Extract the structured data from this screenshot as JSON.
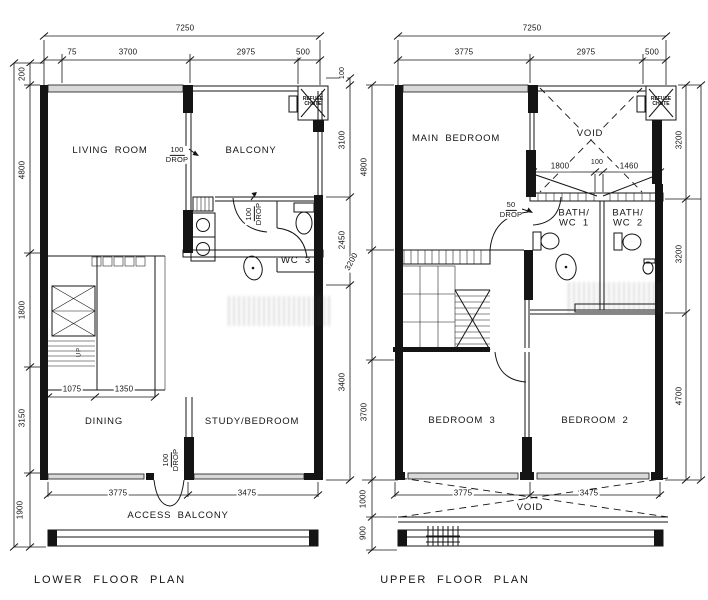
{
  "lower": {
    "title": "LOWER FLOOR PLAN",
    "room_living": "LIVING ROOM",
    "room_balcony": "BALCONY",
    "room_wc3": "WC 3",
    "room_dining": "DINING",
    "room_study": "STUDY/BEDROOM",
    "access_balcony": "ACCESS BALCONY",
    "refuse_chute_l1": "REFUSE",
    "refuse_chute_l2": "CHUTE",
    "up_label": "UP",
    "drop_note_l1": "100",
    "drop_note_l2": "DROP",
    "dim_total_top": "7250",
    "dim_top_75": "75",
    "dim_top_3700": "3700",
    "dim_top_2975": "2975",
    "dim_top_500": "500",
    "dim_left_200": "200",
    "dim_left_4800": "4800",
    "dim_left_1800": "1800",
    "dim_left_3150": "3150",
    "dim_left_1900": "1900",
    "dim_right_100": "100",
    "dim_right_3100": "3100",
    "dim_right_2450": "2450",
    "dim_right_3400": "3400",
    "dim_stair_1075": "1075",
    "dim_stair_1350": "1350",
    "dim_bottom_3775": "3775",
    "dim_bottom_3475": "3475"
  },
  "upper": {
    "title": "UPPER FLOOR PLAN",
    "room_main_bedroom": "MAIN BEDROOM",
    "room_bedroom3": "BEDROOM 3",
    "room_bedroom2": "BEDROOM 2",
    "bath1_l1": "BATH/",
    "bath1_l2": "WC 1",
    "bath2_l1": "BATH/",
    "bath2_l2": "WC 2",
    "void_top": "VOID",
    "void_bottom": "VOID",
    "refuse_chute_l1": "REFUSE",
    "refuse_chute_l2": "CHUTE",
    "drop50_l1": "50",
    "drop50_l2": "DROP",
    "dim_total_top": "7250",
    "dim_top_3775": "3775",
    "dim_top_2975": "2975",
    "dim_top_500": "500",
    "dim_left_4800": "4800",
    "dim_left_3200": "3200",
    "dim_left_3700": "3700",
    "dim_left_1000": "1000",
    "dim_left_900": "900",
    "dim_right_3200a": "3200",
    "dim_right_3200b": "3200",
    "dim_right_4700": "4700",
    "dim_bath_1800": "1800",
    "dim_bath_100": "100",
    "dim_bath_1460": "1460",
    "dim_bottom_3775": "3775",
    "dim_bottom_3475": "3475"
  }
}
